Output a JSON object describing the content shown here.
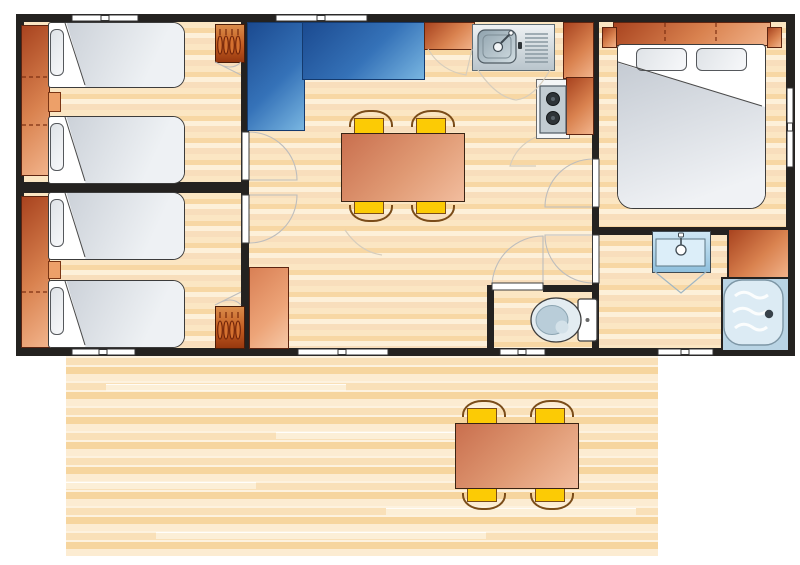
{
  "scene": {
    "type": "floor-plan",
    "subject": "mobile-home-with-terrace",
    "visible_text": ""
  },
  "palette": {
    "wall": "#242220",
    "floor_light": "#fdf0d9",
    "floor_mid": "#f7d7a4",
    "deck_light": "#fcecd2",
    "deck_mid": "#f6d59e",
    "furniture_orange_dark": "#a8431f",
    "furniture_orange_light": "#f2b48c",
    "wardrobe_orange": "#c25b20",
    "table_salmon": "#e09a74",
    "chair_yellow": "#fccb05",
    "chair_frame_brown": "#7a4c19",
    "sofa_blue_dark": "#1b4a90",
    "sofa_blue_light": "#79b6e1",
    "bed_white": "#ffffff",
    "sheet_gray": "#c6ccd4",
    "steel_gray": "#b9c5cc",
    "fixture_blue": "#8fc0dd",
    "shower_blue": "#b9d4e4",
    "door_arc_gray": "#bdbdbd"
  },
  "inventory": {
    "twin_bedrooms": 2,
    "single_beds": 4,
    "double_beds": 1,
    "wardrobes": 2,
    "l_shaped_sofa": 1,
    "dining_tables": 2,
    "chairs": 8,
    "kitchen_sink": 1,
    "hob_burners": 2,
    "washbasin": 1,
    "shower": 1,
    "toilet": 1,
    "interior_doors": 5,
    "windows": 7,
    "terrace": 1
  }
}
